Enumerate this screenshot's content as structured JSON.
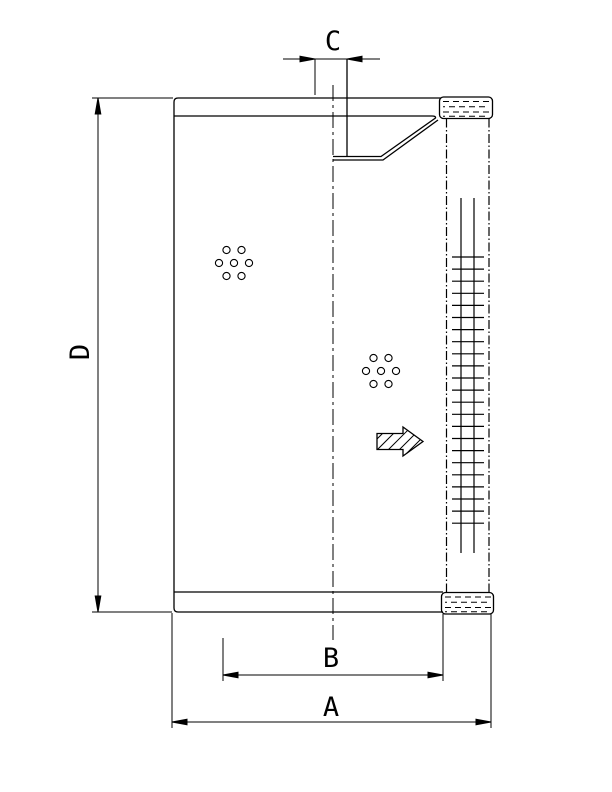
{
  "drawing": {
    "type": "filter-element-cross-section",
    "colors": {
      "line": "#000000",
      "background": "#ffffff"
    },
    "dimensions": {
      "a": {
        "label": "A"
      },
      "b": {
        "label": "B"
      },
      "c": {
        "label": "C"
      },
      "d": {
        "label": "D"
      }
    }
  }
}
